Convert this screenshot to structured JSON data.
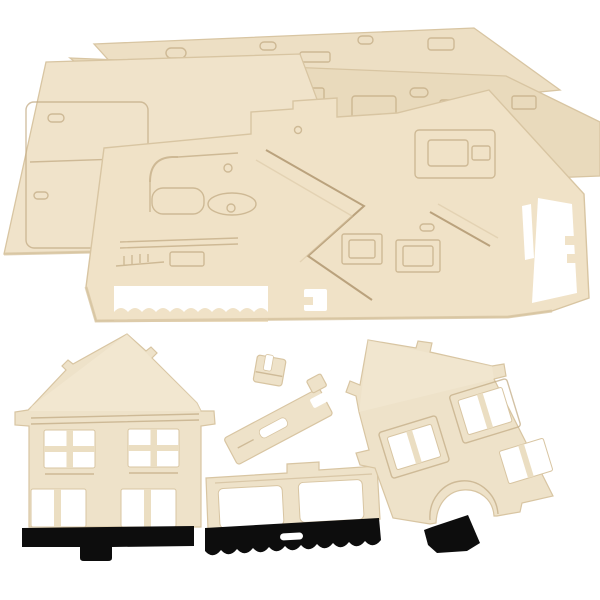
{
  "scene": {
    "subject": "wooden-3d-puzzle-house-kit-photo",
    "sheet_count": 4,
    "piece_count": 5,
    "pieces": {
      "sheet_stack": "stacked plywood punch-out sheets",
      "front_facade": "house gable facade piece (left, upright)",
      "rear_facade": "house gable facade piece (right, tilted)",
      "window_wall": "window wall piece with painted base",
      "chimney": "chimney connector piece",
      "connector": "small slotted connector piece"
    }
  },
  "colors": {
    "background": "#ffffff",
    "wood_sheet_back": "#eddfc4",
    "wood_sheet_mid": "#e9dabc",
    "wood_sheet_left": "#f0e3ca",
    "wood_sheet_front": "#f0e2c7",
    "wood_piece": "#eee2c9",
    "wood_piece_light": "#f6edda",
    "wood_divider": "#ebdec2",
    "wood_edge": "#d8c5a2",
    "cut_line": "#c3ac85",
    "groove_dark": "#b09770",
    "paint_black": "#0d0d0d"
  }
}
